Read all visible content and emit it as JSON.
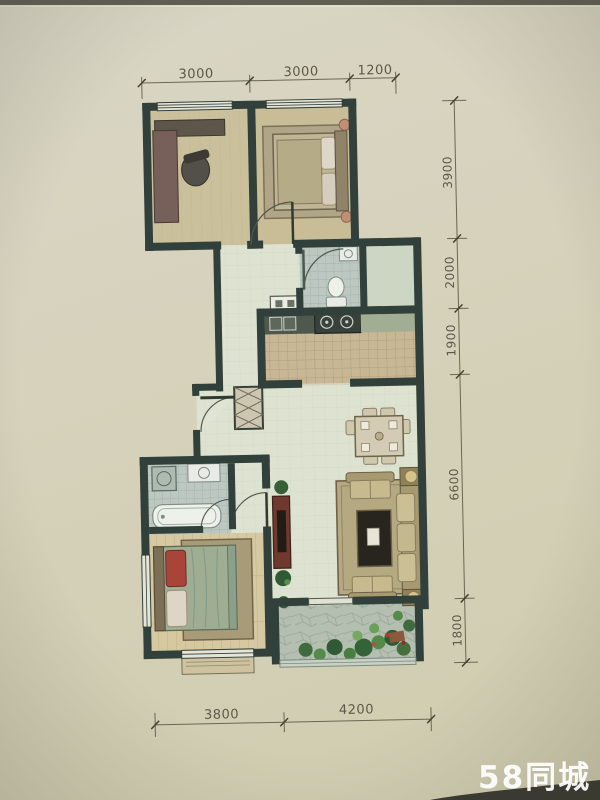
{
  "watermark": {
    "text": "58同城",
    "color": "#ffffff"
  },
  "dimensions": {
    "top": [
      "3000",
      "3000",
      "1200"
    ],
    "right": [
      "3900",
      "2000",
      "1900",
      "6600",
      "1800"
    ],
    "bottom": [
      "3800",
      "4200"
    ]
  },
  "colors": {
    "paper": "#d6d2bd",
    "wall": "#31403a",
    "dimension_text": "#4a483a",
    "bath_tile": "#bcc8c1",
    "kitchen_tile": "#c8b795",
    "wood_floor": "#d6c8a0",
    "living_floor": "#dde3d0",
    "balcony_stone": "#b4bfb1",
    "plant_green": "#3f6b3f",
    "accent_red_furniture": "#70392e"
  }
}
